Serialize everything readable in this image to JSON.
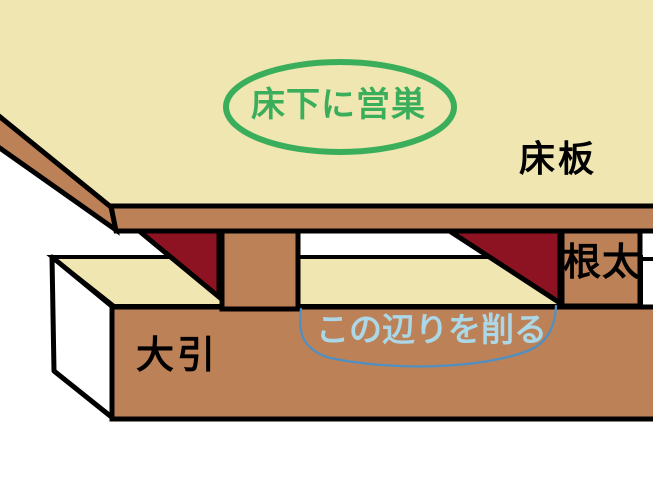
{
  "diagram": {
    "description": "Hand-drawn cross-section diagram of Japanese floor construction with a nesting spot under the floorboards",
    "labels": {
      "floor_board": "床板",
      "joist": "根太",
      "sleeper_beam": "大引",
      "nest_callout": "床下に営巣",
      "shave_area_callout": "この辺りを削る"
    },
    "colors": {
      "surface_cream": "#EFE6B2",
      "wood_brown": "#BD8157",
      "nest_dark_red": "#8E1322",
      "callout_green": "#3BAE5B",
      "shave_text_blue": "#ABD7E7",
      "curve_blue": "#4E90C2",
      "outline_black": "#000000",
      "background_white": "#FFFFFF"
    }
  }
}
